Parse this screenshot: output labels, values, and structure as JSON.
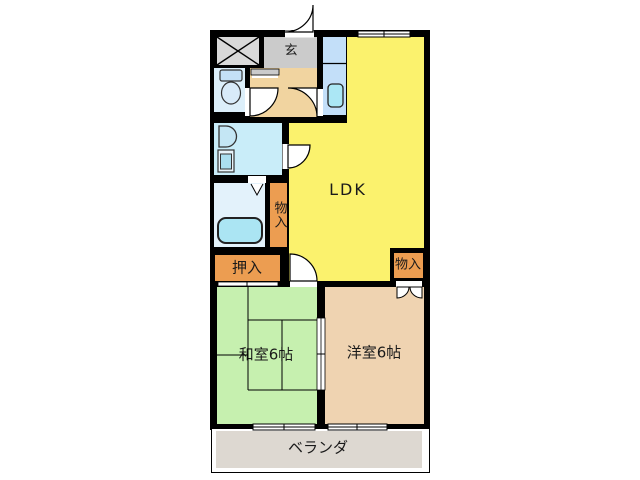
{
  "floorplan": {
    "title": "apartment-floor-plan-2LDK",
    "rooms": {
      "ldk": {
        "label": "LDK"
      },
      "washitsu": {
        "label": "和室6帖"
      },
      "youshitsu": {
        "label": "洋室6帖"
      },
      "veranda": {
        "label": "ベランダ"
      },
      "genkan": {
        "label": "玄"
      },
      "oshiire_closet": {
        "label": "押入"
      },
      "storage_hall": {
        "label": "物入"
      },
      "storage_bedroom": {
        "label": "物入"
      }
    },
    "colors": {
      "wall": "#000000",
      "ldk_yellow": "#FBF26D",
      "tatami_green": "#C6F0AF",
      "western_tan": "#EFD3B1",
      "closet_orange": "#EC9D51",
      "hallway_beige": "#F1D4A0",
      "genkan_gray": "#CBCBCB",
      "elevator_gray": "#D9D9D9",
      "toilet_blue": "#DCEFFA",
      "washroom_blue": "#C9EDF9",
      "bathroom_blue": "#E3F2FB",
      "kitchen_blue": "#C3DFF9",
      "fixture_cyan": "#ABE7F5",
      "veranda_gray": "#DDD8D1"
    }
  }
}
